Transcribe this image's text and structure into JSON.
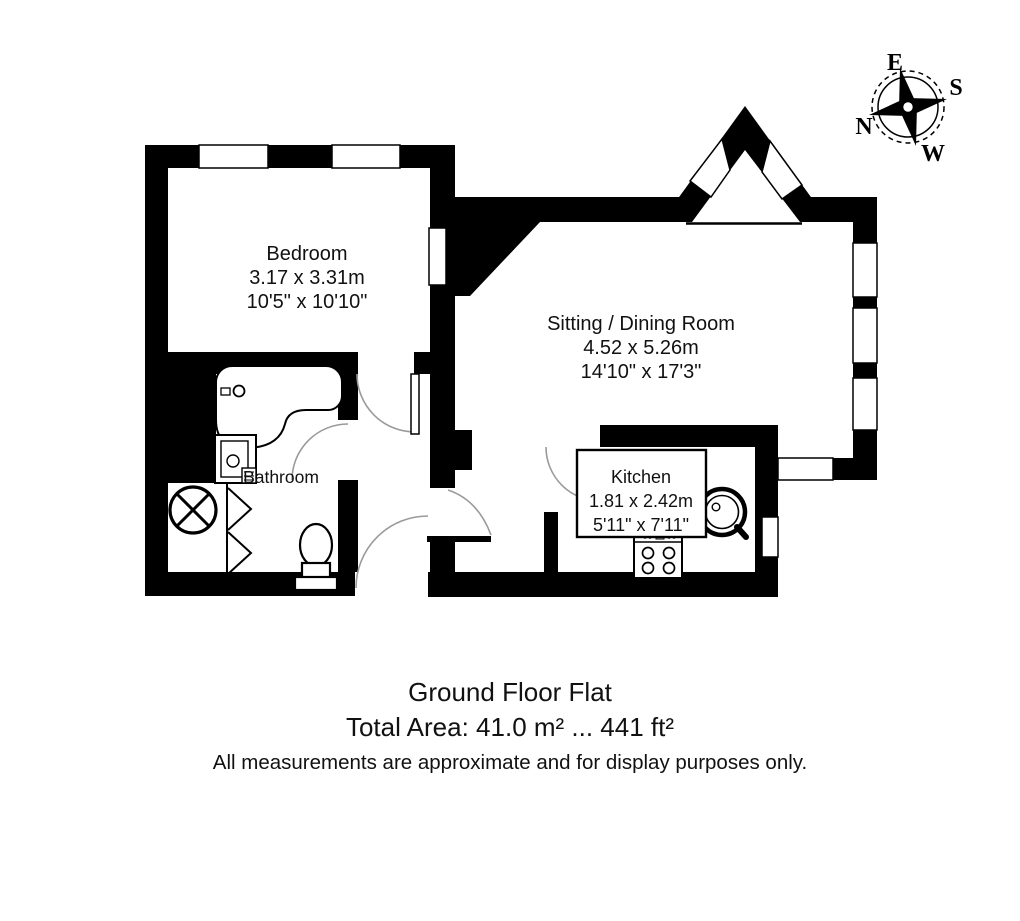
{
  "compass": {
    "north": "N",
    "east": "E",
    "south": "S",
    "west": "W"
  },
  "rooms": {
    "bedroom": {
      "name": "Bedroom",
      "size_metric": "3.17 x 3.31m",
      "size_imperial": "10'5\" x 10'10\""
    },
    "sitting_dining": {
      "name": "Sitting / Dining Room",
      "size_metric": "4.52 x 5.26m",
      "size_imperial": "14'10\" x 17'3\""
    },
    "kitchen": {
      "name": "Kitchen",
      "size_metric": "1.81 x 2.42m",
      "size_imperial": "5'11\" x 7'11\""
    },
    "bathroom": {
      "name": "Bathroom"
    }
  },
  "footer": {
    "title": "Ground Floor Flat",
    "total_area": "Total Area: 41.0 m² ... 441 ft²",
    "disclaimer": "All measurements are approximate and for display purposes only."
  },
  "colors": {
    "walls": "#000000",
    "background": "#ffffff",
    "door_arc": "#9a9a9a"
  }
}
